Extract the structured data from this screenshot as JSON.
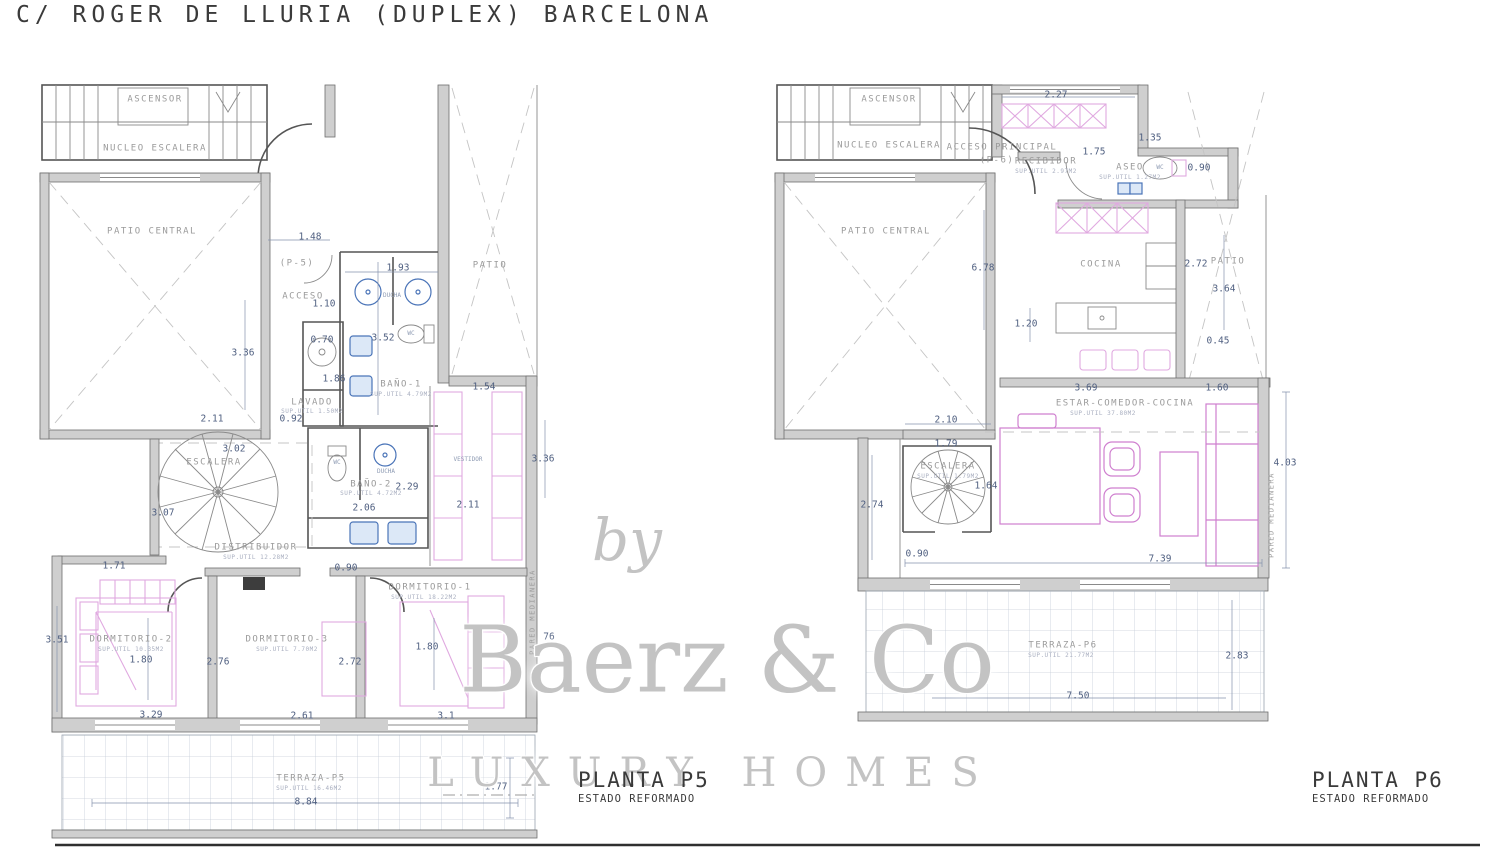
{
  "title": "C/ ROGER DE LLURIA  (DUPLEX) BARCELONA",
  "watermark": {
    "by": "by",
    "brand": "Baerz & Co",
    "tagline": "LUXURY HOMES"
  },
  "plan_p5": {
    "name": "PLANTA P5",
    "status": "ESTADO REFORMADO"
  },
  "plan_p6": {
    "name": "PLANTA P6",
    "status": "ESTADO REFORMADO"
  },
  "colors": {
    "wall_gray": "#cfcfcf",
    "line_dark": "#555555",
    "dimension_blue": "#4f5f80",
    "room_text_gray": "#9b9b9b",
    "furniture_pink": "#d592d5",
    "fixture_blue": "#4a74b8",
    "watermark_gray": "#c3c3c3"
  },
  "labels": [
    {
      "text": "ASCENSOR",
      "x": 155,
      "y": 100,
      "cls": "room",
      "name": "room-label-ascensor-p5"
    },
    {
      "text": "NUCLEO ESCALERA",
      "x": 155,
      "y": 149,
      "cls": "room",
      "name": "room-label-nucleo-escalera-p5"
    },
    {
      "text": "PATIO CENTRAL",
      "x": 152,
      "y": 232,
      "cls": "room",
      "name": "room-label-patio-central-p5"
    },
    {
      "text": "PATIO",
      "x": 490,
      "y": 266,
      "cls": "room",
      "name": "room-label-patio-p5"
    },
    {
      "text": "(P-5)",
      "x": 297,
      "y": 264,
      "cls": "room",
      "name": "label-p5-level"
    },
    {
      "text": "ACCESO",
      "x": 303,
      "y": 297,
      "cls": "room",
      "name": "room-label-acceso-p5"
    },
    {
      "text": "1.48",
      "x": 310,
      "y": 237,
      "cls": "dim"
    },
    {
      "text": "1.93",
      "x": 398,
      "y": 268,
      "cls": "dim"
    },
    {
      "text": "1.10",
      "x": 324,
      "y": 304,
      "cls": "dim"
    },
    {
      "text": "0.70",
      "x": 322,
      "y": 340,
      "cls": "dim"
    },
    {
      "text": "3.52",
      "x": 383,
      "y": 338,
      "cls": "dim"
    },
    {
      "text": "1.86",
      "x": 334,
      "y": 379,
      "cls": "dim"
    },
    {
      "text": "0.92",
      "x": 291,
      "y": 419,
      "cls": "dim"
    },
    {
      "text": "3.36",
      "x": 243,
      "y": 353,
      "cls": "dim"
    },
    {
      "text": "2.11",
      "x": 212,
      "y": 419,
      "cls": "dim"
    },
    {
      "text": "DUCHA",
      "x": 392,
      "y": 296,
      "cls": "tiny"
    },
    {
      "text": "WC",
      "x": 411,
      "y": 334,
      "cls": "tiny"
    },
    {
      "text": "BAÑO-1",
      "x": 401,
      "y": 385,
      "cls": "room",
      "name": "room-label-banyo-1"
    },
    {
      "text": "SUP.UTIL 4.79M2",
      "x": 401,
      "y": 395,
      "cls": "sub"
    },
    {
      "text": "LAVADO",
      "x": 312,
      "y": 403,
      "cls": "room",
      "name": "room-label-lavado"
    },
    {
      "text": "SUP.UTIL 1.50M2",
      "x": 312,
      "y": 412,
      "cls": "sub"
    },
    {
      "text": "1.54",
      "x": 484,
      "y": 387,
      "cls": "dim"
    },
    {
      "text": "VESTIDOR",
      "x": 468,
      "y": 460,
      "cls": "tiny",
      "name": "room-label-vestidor"
    },
    {
      "text": "3.36",
      "x": 543,
      "y": 459,
      "cls": "dim"
    },
    {
      "text": "2.11",
      "x": 468,
      "y": 505,
      "cls": "dim"
    },
    {
      "text": "ESCALERA",
      "x": 214,
      "y": 463,
      "cls": "room",
      "name": "room-label-escalera-p5"
    },
    {
      "text": "3.02",
      "x": 234,
      "y": 449,
      "cls": "dim"
    },
    {
      "text": "3.07",
      "x": 163,
      "y": 513,
      "cls": "dim"
    },
    {
      "text": "WC",
      "x": 337,
      "y": 463,
      "cls": "tiny"
    },
    {
      "text": "DUCHA",
      "x": 386,
      "y": 472,
      "cls": "tiny"
    },
    {
      "text": "BAÑO-2",
      "x": 371,
      "y": 485,
      "cls": "room",
      "name": "room-label-banyo-2"
    },
    {
      "text": "SUP.UTIL 4.72M2",
      "x": 371,
      "y": 494,
      "cls": "sub"
    },
    {
      "text": "2.29",
      "x": 407,
      "y": 487,
      "cls": "dim"
    },
    {
      "text": "2.06",
      "x": 364,
      "y": 508,
      "cls": "dim"
    },
    {
      "text": "DISTRIBUIDOR",
      "x": 256,
      "y": 548,
      "cls": "room",
      "name": "room-label-distribuidor"
    },
    {
      "text": "SUP.UTIL 12.28M2",
      "x": 256,
      "y": 558,
      "cls": "sub"
    },
    {
      "text": "0.90",
      "x": 346,
      "y": 568,
      "cls": "dim"
    },
    {
      "text": "DORMITORIO-1",
      "x": 430,
      "y": 588,
      "cls": "room",
      "name": "room-label-dormitorio-1"
    },
    {
      "text": "SUP.UTIL 18.22M2",
      "x": 424,
      "y": 598,
      "cls": "sub"
    },
    {
      "text": "1.80",
      "x": 427,
      "y": 647,
      "cls": "dim"
    },
    {
      "text": "1.71",
      "x": 114,
      "y": 566,
      "cls": "dim"
    },
    {
      "text": "3.51",
      "x": 57,
      "y": 640,
      "cls": "dim"
    },
    {
      "text": "DORMITORIO-2",
      "x": 131,
      "y": 640,
      "cls": "room",
      "name": "room-label-dormitorio-2"
    },
    {
      "text": "SUP.UTIL 10.35M2",
      "x": 131,
      "y": 650,
      "cls": "sub"
    },
    {
      "text": "1.80",
      "x": 141,
      "y": 660,
      "cls": "dim"
    },
    {
      "text": "2.76",
      "x": 218,
      "y": 662,
      "cls": "dim"
    },
    {
      "text": "DORMITORIO-3",
      "x": 287,
      "y": 640,
      "cls": "room",
      "name": "room-label-dormitorio-3"
    },
    {
      "text": "SUP.UTIL 7.70M2",
      "x": 287,
      "y": 650,
      "cls": "sub"
    },
    {
      "text": "2.72",
      "x": 350,
      "y": 662,
      "cls": "dim"
    },
    {
      "text": "3.29",
      "x": 151,
      "y": 715,
      "cls": "dim"
    },
    {
      "text": "2.61",
      "x": 302,
      "y": 716,
      "cls": "dim"
    },
    {
      "text": "3.1",
      "x": 446,
      "y": 716,
      "cls": "dim"
    },
    {
      "text": "76",
      "x": 549,
      "y": 637,
      "cls": "dim"
    },
    {
      "text": "PARED MEDIANERA",
      "x": 533,
      "y": 612,
      "cls": "vtext",
      "name": "label-pared-medianera-p5"
    },
    {
      "text": "TERRAZA-P5",
      "x": 311,
      "y": 779,
      "cls": "room",
      "name": "room-label-terraza-p5"
    },
    {
      "text": "SUP.UTIL 16.46M2",
      "x": 309,
      "y": 789,
      "cls": "sub"
    },
    {
      "text": "8.84",
      "x": 306,
      "y": 802,
      "cls": "dim"
    },
    {
      "text": "1.77",
      "x": 496,
      "y": 787,
      "cls": "dim"
    },
    {
      "text": "ASCENSOR",
      "x": 889,
      "y": 100,
      "cls": "room",
      "name": "room-label-ascensor-p6"
    },
    {
      "text": "NUCLEO ESCALERA",
      "x": 889,
      "y": 146,
      "cls": "room",
      "name": "room-label-nucleo-escalera-p6"
    },
    {
      "text": "PATIO CENTRAL",
      "x": 886,
      "y": 232,
      "cls": "room",
      "name": "room-label-patio-central-p6"
    },
    {
      "text": "ACCESO PRINCIPAL",
      "x": 1002,
      "y": 148,
      "cls": "room",
      "name": "room-label-acceso-principal"
    },
    {
      "text": "(P-6)",
      "x": 997,
      "y": 161,
      "cls": "room",
      "name": "label-p6-level"
    },
    {
      "text": "RECIBIDOR",
      "x": 1046,
      "y": 162,
      "cls": "room",
      "name": "room-label-recibidor"
    },
    {
      "text": "SUP.UTIL 2.97M2",
      "x": 1046,
      "y": 172,
      "cls": "sub"
    },
    {
      "text": "2.27",
      "x": 1056,
      "y": 95,
      "cls": "dim"
    },
    {
      "text": "1.35",
      "x": 1150,
      "y": 138,
      "cls": "dim"
    },
    {
      "text": "1.75",
      "x": 1094,
      "y": 152,
      "cls": "dim"
    },
    {
      "text": "ASEO",
      "x": 1130,
      "y": 168,
      "cls": "room",
      "name": "room-label-aseo"
    },
    {
      "text": "SUP.UTIL 1.27M2",
      "x": 1130,
      "y": 178,
      "cls": "sub"
    },
    {
      "text": "WC",
      "x": 1160,
      "y": 168,
      "cls": "tiny"
    },
    {
      "text": "0.90",
      "x": 1199,
      "y": 168,
      "cls": "dim"
    },
    {
      "text": "COCINA",
      "x": 1101,
      "y": 265,
      "cls": "room",
      "name": "room-label-cocina"
    },
    {
      "text": "PATIO",
      "x": 1228,
      "y": 262,
      "cls": "room",
      "name": "room-label-patio-p6"
    },
    {
      "text": "2.72",
      "x": 1196,
      "y": 264,
      "cls": "dim"
    },
    {
      "text": "3.64",
      "x": 1224,
      "y": 289,
      "cls": "dim"
    },
    {
      "text": "6.78",
      "x": 983,
      "y": 268,
      "cls": "dim"
    },
    {
      "text": "1.20",
      "x": 1026,
      "y": 324,
      "cls": "dim"
    },
    {
      "text": "0.45",
      "x": 1218,
      "y": 341,
      "cls": "dim"
    },
    {
      "text": "3.69",
      "x": 1086,
      "y": 388,
      "cls": "dim"
    },
    {
      "text": "1.60",
      "x": 1217,
      "y": 388,
      "cls": "dim"
    },
    {
      "text": "ESTAR-COMEDOR-COCINA",
      "x": 1125,
      "y": 404,
      "cls": "room",
      "name": "room-label-estar-comedor-cocina"
    },
    {
      "text": "SUP.UTIL 37.80M2",
      "x": 1103,
      "y": 414,
      "cls": "sub"
    },
    {
      "text": "2.10",
      "x": 946,
      "y": 420,
      "cls": "dim"
    },
    {
      "text": "1.79",
      "x": 946,
      "y": 444,
      "cls": "dim"
    },
    {
      "text": "ESCALERA",
      "x": 948,
      "y": 467,
      "cls": "room",
      "name": "room-label-escalera-p6"
    },
    {
      "text": "SUP.UTIL 1.79M2",
      "x": 948,
      "y": 477,
      "cls": "sub"
    },
    {
      "text": "1.64",
      "x": 986,
      "y": 486,
      "cls": "dim"
    },
    {
      "text": "2.74",
      "x": 872,
      "y": 505,
      "cls": "dim"
    },
    {
      "text": "0.90",
      "x": 917,
      "y": 554,
      "cls": "dim"
    },
    {
      "text": "7.39",
      "x": 1160,
      "y": 559,
      "cls": "dim"
    },
    {
      "text": "4.03",
      "x": 1285,
      "y": 463,
      "cls": "dim"
    },
    {
      "text": "PARED MEDIANERA",
      "x": 1272,
      "y": 515,
      "cls": "vtext",
      "name": "label-pared-medianera-p6"
    },
    {
      "text": "TERRAZA-P6",
      "x": 1063,
      "y": 646,
      "cls": "room",
      "name": "room-label-terraza-p6"
    },
    {
      "text": "SUP.UTIL 21.77M2",
      "x": 1061,
      "y": 656,
      "cls": "sub"
    },
    {
      "text": "2.83",
      "x": 1237,
      "y": 656,
      "cls": "dim"
    },
    {
      "text": "7.50",
      "x": 1078,
      "y": 696,
      "cls": "dim"
    }
  ]
}
